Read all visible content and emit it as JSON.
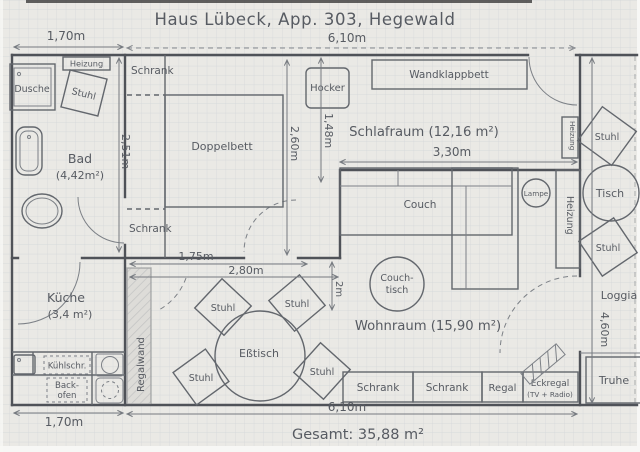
{
  "title": "Haus Lübeck, App. 303, Hegewald",
  "total_label": "Gesamt: 35,88 m²",
  "rooms": {
    "bad_name": "Bad",
    "bad_area": "(4,42m²)",
    "kueche_name": "Küche",
    "kueche_area": "(3,4 m²)",
    "schlafraum": "Schlafraum (12,16 m²)",
    "wohnraum": "Wohnraum (15,90 m²)",
    "loggia": "Loggia"
  },
  "furniture": {
    "dusche": "Dusche",
    "stuhl": "Stuhl",
    "heizung": "Heizung",
    "schrank": "Schrank",
    "doppelbett": "Doppelbett",
    "hocker": "Hocker",
    "wandklappbett": "Wandklappbett",
    "couch": "Couch",
    "lampe": "Lampe",
    "tisch": "Tisch",
    "couchtisch_line1": "Couch-",
    "couchtisch_line2": "tisch",
    "esstisch": "Eßtisch",
    "regalwand": "Regalwand",
    "regal": "Regal",
    "eckregal_line1": "Eckregal",
    "eckregal_line2": "(TV + Radio)",
    "truhe": "Truhe",
    "kuehlschrank": "Kühlschr.",
    "backofen_line1": "Back-",
    "backofen_line2": "ofen"
  },
  "dimensions": {
    "bath_width": "1,70m",
    "main_width_top": "6,10m",
    "bath_height": "2,51m",
    "bed_depth": "2,60m",
    "hocker_depth": "1,48m",
    "schlafraum_width": "3,30m",
    "dining_width_1": "1,75m",
    "dining_width_2": "2,80m",
    "couch_depth": "2m",
    "kitchen_width_bottom": "1,70m",
    "main_width_bottom": "6,10m",
    "loggia_height": "4,60m"
  },
  "colors": {
    "pencil": "#575b62",
    "paper": "#eae9e5",
    "grid": "#bfc6cf"
  }
}
